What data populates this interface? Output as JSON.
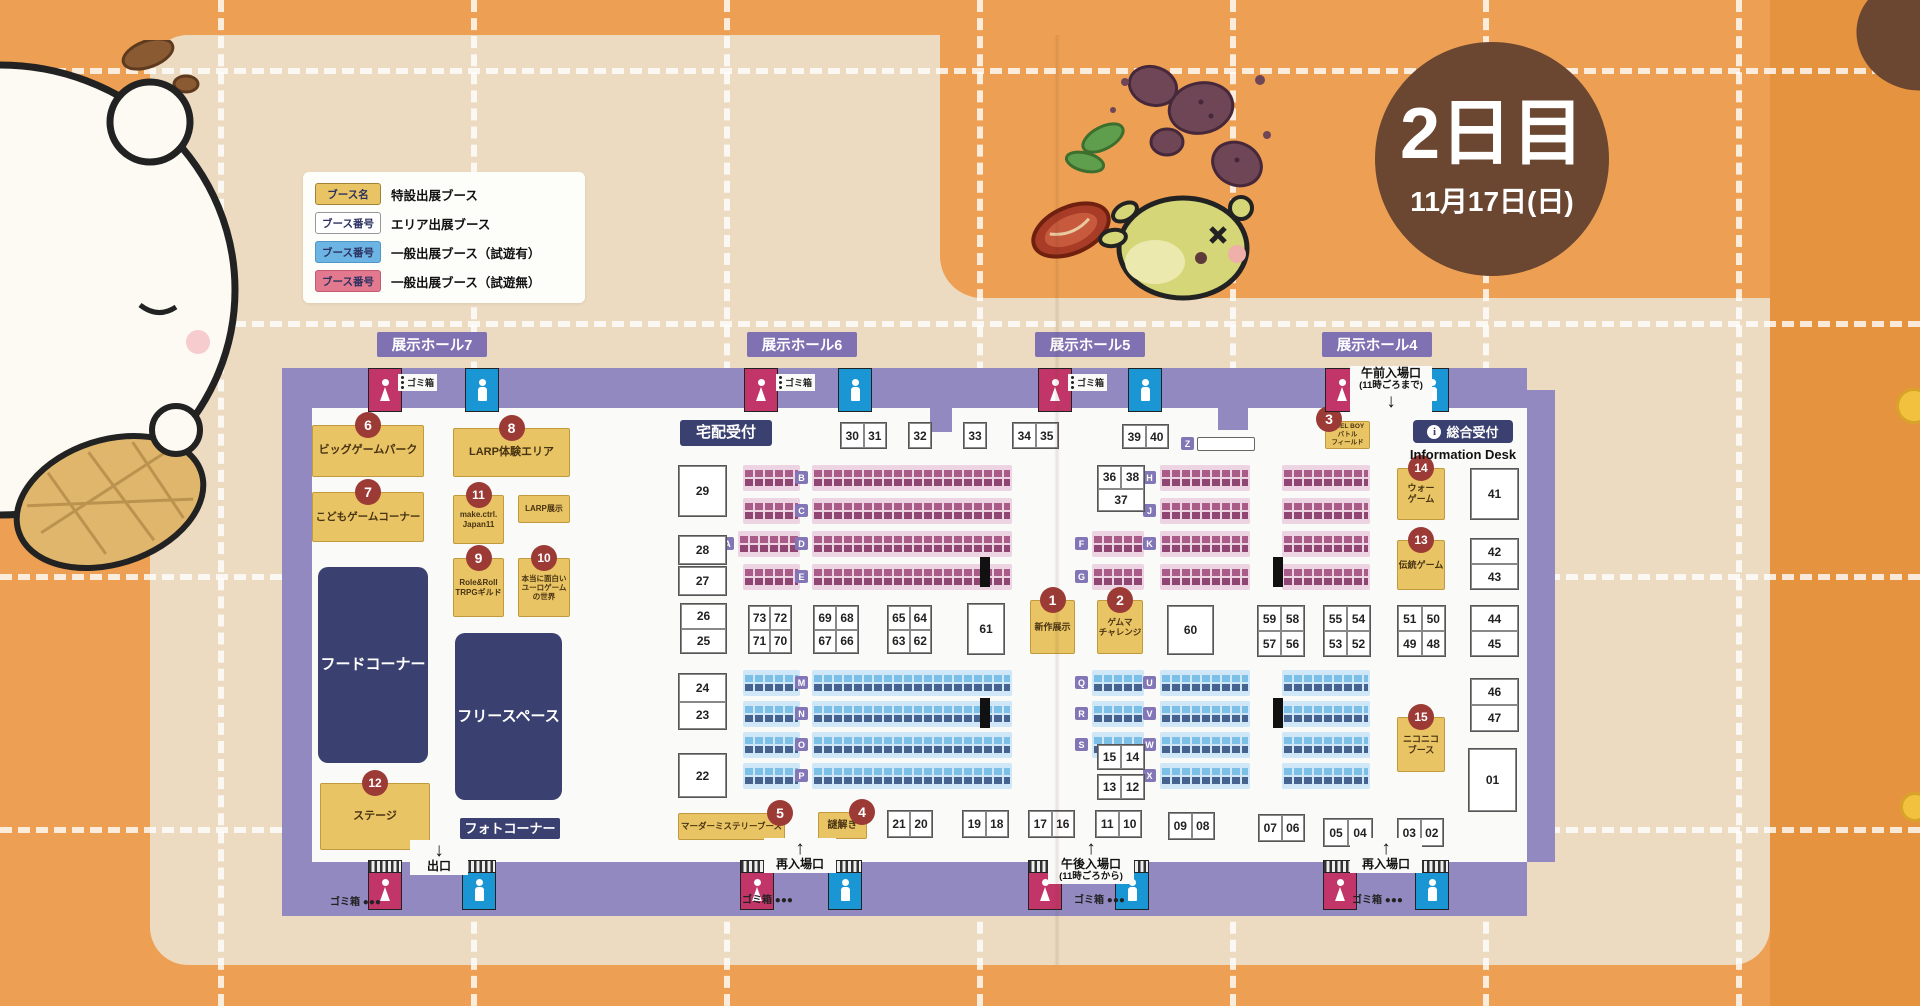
{
  "title": {
    "day": "2日目",
    "date": "11月17日(日)"
  },
  "colors": {
    "background_orange": "#eda053",
    "mat_beige": "#ecdbc0",
    "map_purple": "#9289c0",
    "special_booth_yellow": "#e9c464",
    "badge_red": "#9c3a36",
    "facility_navy": "#3a4070",
    "womens_pink": "#c23568",
    "mens_blue": "#1b96d4",
    "trial_blue": "#6cb4e4",
    "no_trial_pink": "#e2798f",
    "day_badge_brown": "#6b4630"
  },
  "legend": {
    "rows": [
      {
        "chip": "ブース名",
        "type": "special",
        "label": "特設出展ブース"
      },
      {
        "chip": "ブース番号",
        "type": "area",
        "label": "エリア出展ブース"
      },
      {
        "chip": "ブース番号",
        "type": "trial",
        "label": "一般出展ブース（試遊有）"
      },
      {
        "chip": "ブース番号",
        "type": "no_trial",
        "label": "一般出展ブース（試遊無）"
      }
    ]
  },
  "halls": [
    {
      "name": "展示ホール7",
      "x": 377
    },
    {
      "name": "展示ホール6",
      "x": 747
    },
    {
      "name": "展示ホール5",
      "x": 1035
    },
    {
      "name": "展示ホール4",
      "x": 1322
    }
  ],
  "info_desk": {
    "icon": "i",
    "label": "総合受付",
    "sub": "Information Desk"
  },
  "special_booths": [
    {
      "num": "1",
      "label": "新作展示",
      "x": 1030,
      "y": 600,
      "w": 43,
      "h": 52,
      "fs": 9,
      "badge_pos": "top"
    },
    {
      "num": "2",
      "label": "ゲムマ\nチャレンジ",
      "x": 1097,
      "y": 600,
      "w": 44,
      "h": 52,
      "fs": 8.5,
      "badge_pos": "top"
    },
    {
      "num": "3",
      "label": "DUEL BOY\nバトル\nフィールド",
      "x": 1325,
      "y": 421,
      "w": 43,
      "h": 26,
      "fs": 6.5,
      "badge_pos": "topleft"
    },
    {
      "num": "4",
      "label": "謎解き",
      "x": 818,
      "y": 812,
      "w": 47,
      "h": 25,
      "fs": 10,
      "badge_pos": "topright"
    },
    {
      "num": "5",
      "label": "マーダーミステリーブース",
      "x": 678,
      "y": 813,
      "w": 105,
      "h": 25,
      "fs": 8.5,
      "badge_pos": "topright"
    },
    {
      "num": "6",
      "label": "ビッグゲームパーク",
      "x": 312,
      "y": 425,
      "w": 110,
      "h": 50,
      "fs": 11,
      "badge_pos": "top"
    },
    {
      "num": "7",
      "label": "こどもゲームコーナー",
      "x": 312,
      "y": 492,
      "w": 110,
      "h": 48,
      "fs": 10.5,
      "badge_pos": "top"
    },
    {
      "num": "8",
      "label": "LARP体験エリア",
      "x": 453,
      "y": 428,
      "w": 115,
      "h": 47,
      "fs": 11,
      "badge_pos": "top"
    },
    {
      "num": "9",
      "label": "Role&Roll\nTRPGギルド",
      "x": 453,
      "y": 558,
      "w": 49,
      "h": 57,
      "fs": 8,
      "badge_pos": "top"
    },
    {
      "num": "10",
      "label": "本当に面白い\nユーロゲーム\nの世界",
      "x": 518,
      "y": 558,
      "w": 50,
      "h": 57,
      "fs": 7.5,
      "badge_pos": "top"
    },
    {
      "num": "11",
      "label": "make.ctrl.\nJapan11",
      "x": 453,
      "y": 495,
      "w": 49,
      "h": 47,
      "fs": 8,
      "badge_pos": "top"
    },
    {
      "num": "12",
      "label": "ステージ",
      "x": 320,
      "y": 783,
      "w": 108,
      "h": 65,
      "fs": 11,
      "badge_pos": "top"
    },
    {
      "num": "13",
      "label": "伝統ゲーム",
      "x": 1397,
      "y": 540,
      "w": 46,
      "h": 48,
      "fs": 9,
      "badge_pos": "top"
    },
    {
      "num": "14",
      "label": "ウォー\nゲーム",
      "x": 1397,
      "y": 468,
      "w": 46,
      "h": 50,
      "fs": 9,
      "badge_pos": "top"
    },
    {
      "num": "15",
      "label": "ニコニコ\nブース",
      "x": 1397,
      "y": 717,
      "w": 46,
      "h": 53,
      "fs": 9,
      "badge_pos": "top"
    },
    {
      "num": null,
      "label": "LARP展示",
      "x": 518,
      "y": 495,
      "w": 50,
      "h": 26,
      "fs": 8,
      "badge_pos": "top"
    }
  ],
  "facilities": [
    {
      "label": "宅配受付",
      "x": 680,
      "y": 420,
      "w": 92,
      "h": 26,
      "fs": 15,
      "r": 3
    },
    {
      "label": "フードコーナー",
      "x": 318,
      "y": 567,
      "w": 110,
      "h": 196,
      "fs": 15,
      "r": 10
    },
    {
      "label": "フリースペース",
      "x": 455,
      "y": 633,
      "w": 107,
      "h": 167,
      "fs": 15,
      "r": 10
    },
    {
      "label": "フォトコーナー",
      "x": 460,
      "y": 818,
      "w": 100,
      "h": 21,
      "fs": 13,
      "r": 2
    }
  ],
  "area_booths": [
    {
      "labels": [
        "29"
      ],
      "x": 678,
      "y": 465,
      "w": 47,
      "h": 50,
      "cols": 1
    },
    {
      "labels": [
        "28"
      ],
      "x": 678,
      "y": 535,
      "w": 47,
      "h": 28,
      "cols": 1
    },
    {
      "labels": [
        "27"
      ],
      "x": 678,
      "y": 566,
      "w": 47,
      "h": 28,
      "cols": 1
    },
    {
      "labels": [
        "26",
        "25"
      ],
      "x": 680,
      "y": 603,
      "w": 45,
      "h": 49,
      "cols": 1
    },
    {
      "labels": [
        "24",
        "23"
      ],
      "x": 678,
      "y": 673,
      "w": 47,
      "h": 55,
      "cols": 1
    },
    {
      "labels": [
        "22"
      ],
      "x": 678,
      "y": 753,
      "w": 47,
      "h": 43,
      "cols": 1
    },
    {
      "labels": [
        "30",
        "31"
      ],
      "x": 840,
      "y": 422,
      "w": 45,
      "h": 25,
      "cols": 2
    },
    {
      "labels": [
        "32"
      ],
      "x": 908,
      "y": 422,
      "w": 22,
      "h": 25,
      "cols": 1
    },
    {
      "labels": [
        "33"
      ],
      "x": 963,
      "y": 422,
      "w": 22,
      "h": 25,
      "cols": 1
    },
    {
      "labels": [
        "34",
        "35"
      ],
      "x": 1012,
      "y": 422,
      "w": 45,
      "h": 25,
      "cols": 2
    },
    {
      "labels": [
        "39",
        "40"
      ],
      "x": 1122,
      "y": 424,
      "w": 45,
      "h": 23,
      "cols": 2
    },
    {
      "labels": [
        "36",
        "38",
        "37"
      ],
      "x": 1097,
      "y": 465,
      "w": 46,
      "h": 45,
      "cols": 2,
      "span_last": true
    },
    {
      "labels": [
        "73",
        "72",
        "71",
        "70"
      ],
      "x": 748,
      "y": 605,
      "w": 42,
      "h": 47,
      "cols": 2
    },
    {
      "labels": [
        "69",
        "68",
        "67",
        "66"
      ],
      "x": 813,
      "y": 605,
      "w": 44,
      "h": 47,
      "cols": 2
    },
    {
      "labels": [
        "65",
        "64",
        "63",
        "62"
      ],
      "x": 887,
      "y": 605,
      "w": 43,
      "h": 47,
      "cols": 2
    },
    {
      "labels": [
        "61"
      ],
      "x": 967,
      "y": 603,
      "w": 36,
      "h": 50,
      "cols": 1
    },
    {
      "labels": [
        "60"
      ],
      "x": 1167,
      "y": 605,
      "w": 45,
      "h": 48,
      "cols": 1
    },
    {
      "labels": [
        "59",
        "58",
        "57",
        "56"
      ],
      "x": 1257,
      "y": 605,
      "w": 46,
      "h": 50,
      "cols": 2
    },
    {
      "labels": [
        "55",
        "54",
        "53",
        "52"
      ],
      "x": 1323,
      "y": 605,
      "w": 46,
      "h": 50,
      "cols": 2
    },
    {
      "labels": [
        "51",
        "50",
        "49",
        "48"
      ],
      "x": 1397,
      "y": 605,
      "w": 47,
      "h": 50,
      "cols": 2
    },
    {
      "labels": [
        "15",
        "14"
      ],
      "x": 1097,
      "y": 744,
      "w": 46,
      "h": 24,
      "cols": 2
    },
    {
      "labels": [
        "13",
        "12"
      ],
      "x": 1097,
      "y": 774,
      "w": 46,
      "h": 24,
      "cols": 2
    },
    {
      "labels": [
        "21",
        "20"
      ],
      "x": 887,
      "y": 810,
      "w": 44,
      "h": 26,
      "cols": 2
    },
    {
      "labels": [
        "19",
        "18"
      ],
      "x": 962,
      "y": 810,
      "w": 45,
      "h": 26,
      "cols": 2
    },
    {
      "labels": [
        "17",
        "16"
      ],
      "x": 1028,
      "y": 810,
      "w": 45,
      "h": 26,
      "cols": 2
    },
    {
      "labels": [
        "11",
        "10"
      ],
      "x": 1095,
      "y": 810,
      "w": 45,
      "h": 26,
      "cols": 2
    },
    {
      "labels": [
        "09",
        "08"
      ],
      "x": 1168,
      "y": 812,
      "w": 45,
      "h": 26,
      "cols": 2
    },
    {
      "labels": [
        "07",
        "06"
      ],
      "x": 1258,
      "y": 814,
      "w": 45,
      "h": 26,
      "cols": 2
    },
    {
      "labels": [
        "05",
        "04"
      ],
      "x": 1323,
      "y": 818,
      "w": 48,
      "h": 27,
      "cols": 2
    },
    {
      "labels": [
        "03",
        "02"
      ],
      "x": 1397,
      "y": 818,
      "w": 45,
      "h": 27,
      "cols": 2
    },
    {
      "labels": [
        "41"
      ],
      "x": 1470,
      "y": 468,
      "w": 47,
      "h": 50,
      "cols": 1
    },
    {
      "labels": [
        "42",
        "43"
      ],
      "x": 1470,
      "y": 538,
      "w": 47,
      "h": 50,
      "cols": 1
    },
    {
      "labels": [
        "44",
        "45"
      ],
      "x": 1470,
      "y": 605,
      "w": 47,
      "h": 50,
      "cols": 1
    },
    {
      "labels": [
        "46",
        "47"
      ],
      "x": 1470,
      "y": 678,
      "w": 47,
      "h": 52,
      "cols": 1
    },
    {
      "labels": [
        "01"
      ],
      "x": 1468,
      "y": 748,
      "w": 47,
      "h": 62,
      "cols": 1
    }
  ],
  "strips": [
    {
      "x": 743,
      "y": 465,
      "w": 57,
      "color": "pink"
    },
    {
      "x": 812,
      "y": 465,
      "w": 200,
      "color": "pink",
      "letter": "B"
    },
    {
      "x": 1160,
      "y": 465,
      "w": 90,
      "color": "pink",
      "letter": "H"
    },
    {
      "x": 1282,
      "y": 465,
      "w": 88,
      "color": "pink"
    },
    {
      "x": 743,
      "y": 498,
      "w": 57,
      "color": "pink"
    },
    {
      "x": 812,
      "y": 498,
      "w": 200,
      "color": "pink",
      "letter": "C"
    },
    {
      "x": 1160,
      "y": 498,
      "w": 90,
      "color": "pink",
      "letter": "J"
    },
    {
      "x": 1282,
      "y": 498,
      "w": 88,
      "color": "pink"
    },
    {
      "x": 738,
      "y": 531,
      "w": 62,
      "color": "pink",
      "letter": "A"
    },
    {
      "x": 812,
      "y": 531,
      "w": 200,
      "color": "pink",
      "letter": "D"
    },
    {
      "x": 1092,
      "y": 531,
      "w": 52,
      "color": "pink",
      "letter": "F"
    },
    {
      "x": 1160,
      "y": 531,
      "w": 90,
      "color": "pink",
      "letter": "K"
    },
    {
      "x": 1282,
      "y": 531,
      "w": 88,
      "color": "pink"
    },
    {
      "x": 743,
      "y": 564,
      "w": 57,
      "color": "pink"
    },
    {
      "x": 812,
      "y": 564,
      "w": 200,
      "color": "pink",
      "letter": "E"
    },
    {
      "x": 1092,
      "y": 564,
      "w": 52,
      "color": "pink",
      "letter": "G"
    },
    {
      "x": 1160,
      "y": 564,
      "w": 90,
      "color": "pink"
    },
    {
      "x": 1282,
      "y": 564,
      "w": 88,
      "color": "pink"
    },
    {
      "x": 743,
      "y": 670,
      "w": 57,
      "color": "blue"
    },
    {
      "x": 812,
      "y": 670,
      "w": 200,
      "color": "blue",
      "letter": "M"
    },
    {
      "x": 1092,
      "y": 670,
      "w": 52,
      "color": "blue",
      "letter": "Q"
    },
    {
      "x": 1160,
      "y": 670,
      "w": 90,
      "color": "blue",
      "letter": "U"
    },
    {
      "x": 1282,
      "y": 670,
      "w": 88,
      "color": "blue"
    },
    {
      "x": 743,
      "y": 701,
      "w": 57,
      "color": "blue"
    },
    {
      "x": 812,
      "y": 701,
      "w": 200,
      "color": "blue",
      "letter": "N"
    },
    {
      "x": 1092,
      "y": 701,
      "w": 52,
      "color": "blue",
      "letter": "R"
    },
    {
      "x": 1160,
      "y": 701,
      "w": 90,
      "color": "blue",
      "letter": "V"
    },
    {
      "x": 1282,
      "y": 701,
      "w": 88,
      "color": "blue"
    },
    {
      "x": 743,
      "y": 732,
      "w": 57,
      "color": "blue"
    },
    {
      "x": 812,
      "y": 732,
      "w": 200,
      "color": "blue",
      "letter": "O"
    },
    {
      "x": 1092,
      "y": 732,
      "w": 52,
      "color": "blue",
      "letter": "S"
    },
    {
      "x": 1160,
      "y": 732,
      "w": 90,
      "color": "blue",
      "letter": "W"
    },
    {
      "x": 1282,
      "y": 732,
      "w": 88,
      "color": "blue"
    },
    {
      "x": 743,
      "y": 763,
      "w": 57,
      "color": "blue"
    },
    {
      "x": 812,
      "y": 763,
      "w": 200,
      "color": "blue",
      "letter": "P"
    },
    {
      "x": 1160,
      "y": 763,
      "w": 90,
      "color": "blue",
      "letter": "X"
    },
    {
      "x": 1282,
      "y": 763,
      "w": 88,
      "color": "blue"
    },
    {
      "x": 1197,
      "y": 437,
      "w": 56,
      "h": 12,
      "color": "plain",
      "letter": "Z"
    }
  ],
  "restrooms": [
    {
      "type": "f",
      "x": 368,
      "y": 368
    },
    {
      "type": "m",
      "x": 465,
      "y": 368
    },
    {
      "type": "f",
      "x": 744,
      "y": 368
    },
    {
      "type": "m",
      "x": 838,
      "y": 368
    },
    {
      "type": "f",
      "x": 1038,
      "y": 368
    },
    {
      "type": "m",
      "x": 1128,
      "y": 368
    },
    {
      "type": "f",
      "x": 1325,
      "y": 368
    },
    {
      "type": "m",
      "x": 1415,
      "y": 368
    },
    {
      "type": "f",
      "x": 368,
      "y": 860,
      "bottom": true
    },
    {
      "type": "m",
      "x": 462,
      "y": 860,
      "bottom": true
    },
    {
      "type": "f",
      "x": 740,
      "y": 860,
      "bottom": true
    },
    {
      "type": "m",
      "x": 828,
      "y": 860,
      "bottom": true
    },
    {
      "type": "f",
      "x": 1028,
      "y": 860,
      "bottom": true
    },
    {
      "type": "m",
      "x": 1115,
      "y": 860,
      "bottom": true
    },
    {
      "type": "f",
      "x": 1323,
      "y": 860,
      "bottom": true
    },
    {
      "type": "m",
      "x": 1415,
      "y": 860,
      "bottom": true
    }
  ],
  "entrances": [
    {
      "label": "出口",
      "arrow": "↓",
      "x": 410,
      "y": 840,
      "w": 52,
      "arrow_first": true
    },
    {
      "label": "再入場口",
      "arrow": "↑",
      "x": 764,
      "y": 838,
      "w": 66,
      "arrow_first": true
    },
    {
      "label": "午後入場口",
      "sub": "(11時ごろから)",
      "arrow": "↑",
      "x": 1048,
      "y": 838,
      "w": 80,
      "arrow_first": true
    },
    {
      "label": "再入場口",
      "arrow": "↑",
      "x": 1350,
      "y": 838,
      "w": 66,
      "arrow_first": true
    },
    {
      "label": "午前入場口",
      "sub": "(11時ごろまで)",
      "arrow": "↓",
      "x": 1350,
      "y": 366,
      "w": 76,
      "arrow_first": false
    }
  ],
  "trash_labels": [
    {
      "x": 398,
      "y": 374,
      "text": "ゴミ箱",
      "dots": "v"
    },
    {
      "x": 776,
      "y": 374,
      "text": "ゴミ箱",
      "dots": "v"
    },
    {
      "x": 1068,
      "y": 374,
      "text": "ゴミ箱",
      "dots": "v"
    },
    {
      "x": 330,
      "y": 893,
      "text": "ゴミ箱 ●●●",
      "dots": "h"
    },
    {
      "x": 742,
      "y": 891,
      "text": "ゴミ箱 ●●●",
      "dots": "h"
    },
    {
      "x": 1074,
      "y": 891,
      "text": "ゴミ箱 ●●●",
      "dots": "h"
    },
    {
      "x": 1352,
      "y": 891,
      "text": "ゴミ箱 ●●●",
      "dots": "h"
    }
  ],
  "pillars": [
    {
      "x": 980,
      "y": 557
    },
    {
      "x": 1273,
      "y": 557
    },
    {
      "x": 980,
      "y": 698
    },
    {
      "x": 1273,
      "y": 698
    }
  ]
}
